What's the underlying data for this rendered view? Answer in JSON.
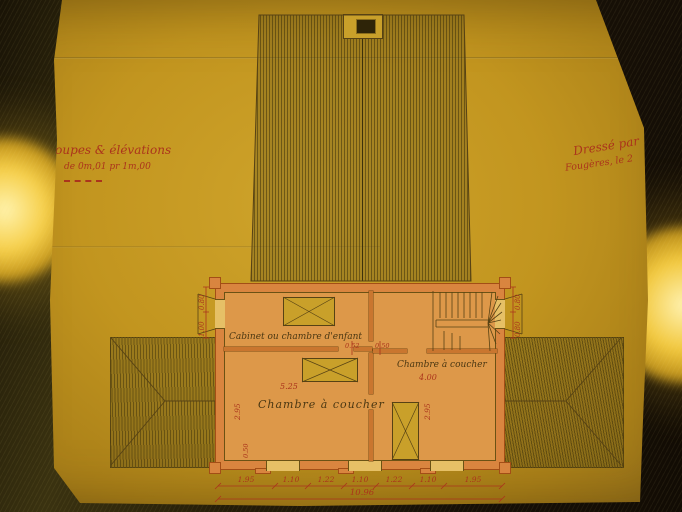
{
  "document": {
    "kind": "old architectural drawing photographed on a brass copy stand",
    "notes": {
      "scale_note_line1": "Coupes & élévations",
      "scale_note_line2": "de 0m,01 pr 1m,00",
      "signature_line1": "Dressé par",
      "signature_line2": "Fougères, le 2"
    },
    "rooms": {
      "child_room": "Cabinet ou chambre d'enfant",
      "bedroom_left": "Chambre à coucher",
      "bedroom_right": "Chambre à coucher"
    },
    "dimensions": {
      "bottom_segments": [
        "1.95",
        "1.10",
        "1.22",
        "1.10",
        "1.22",
        "1.10",
        "1.95"
      ],
      "bottom_total": "10.96",
      "bedroom_left_width": "5.25",
      "bedroom_left_depth": "2.95",
      "bedroom_right_width": "4.00",
      "bedroom_right_depth": "2.95",
      "center_partition_a": "0.52",
      "center_partition_b": "0.50",
      "left_wall_upper": "0.80",
      "left_wall_lower": "1.00",
      "right_wall_upper": "0.80",
      "right_wall_lower": "0.80",
      "corner_left": "0.50"
    },
    "colors": {
      "paper": "#c39522",
      "wall_poche": "#d9853f",
      "ink": "#4a3712",
      "red_ink": "#ab341c",
      "lamp_gold": "#f2c83e",
      "backdrop": "#1a1306"
    }
  }
}
